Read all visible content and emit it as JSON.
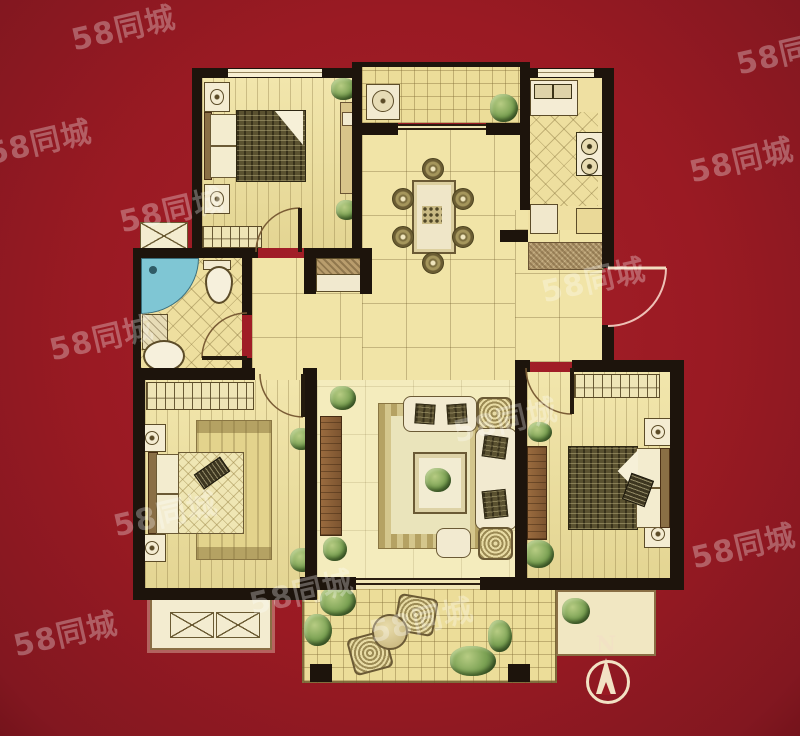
{
  "watermark": {
    "text": "58同城"
  },
  "compass": {
    "label": "N"
  },
  "colors": {
    "background_red": "#9e1b23",
    "wall_black": "#1d140c",
    "floor_cream": "#eedf9f",
    "tile_line_brown": "#8a7a4a",
    "shower_blue": "#7fc6d4",
    "entry_door_arc_pink": "#eec0b6",
    "watermark_white": "rgba(255,255,255,0.30)",
    "compass_cream": "#f2e2c4",
    "furniture_dark_olive": "#5a5130",
    "wood_brown": "#8a5f38"
  }
}
